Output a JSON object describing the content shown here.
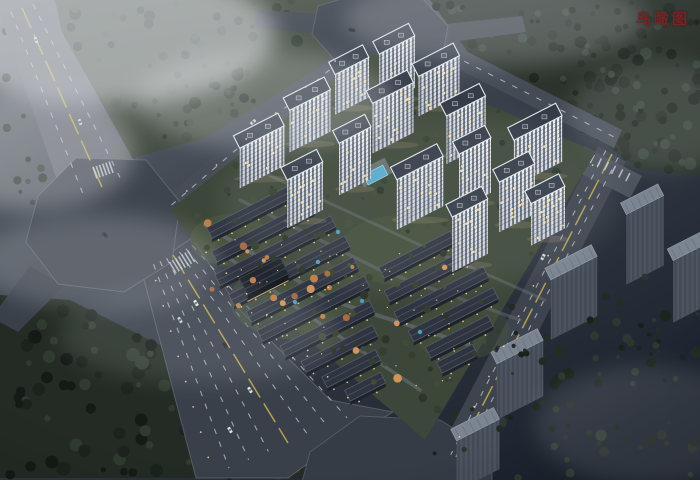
{
  "page": {
    "title_label": "鸟瞰图",
    "title_color": "#7a2125"
  },
  "scene": {
    "w": 700,
    "h": 480,
    "axis_deg": -27,
    "palette": {
      "bg_stops": [
        "#6a6f76",
        "#3a414b",
        "#1b212c"
      ],
      "lane_white": "#b6bec8",
      "lane_yellow": "#c7b14e",
      "tower_roof": "#333b47",
      "tower_trim": "#e3e8ee",
      "facade_top": "#f0f3f6",
      "facade_bot": "#c6ced7",
      "tower_side": "#a9b2bc",
      "window": "#46505c",
      "lit": "#ffdf9e",
      "floor_line": "rgba(52,60,72,0.4)",
      "ctx_roof": "#7b8491",
      "ctx_edge": "#99a1ad",
      "ctx_front": "#4d5561",
      "ctx_stripe": "#424a56",
      "ctx_side": "#363d48",
      "ctx_notch": "#6b7380",
      "villa_roof": "#2e3540",
      "villa_edge": "#525b66",
      "villa_front": "#1d232b",
      "villa_lit": "#f3c67e",
      "club_roof": "#20262e",
      "club_front": "#14181f",
      "club_trim": "#d9b97c",
      "pool": "#57aacb",
      "pool_edge": "#8fd0e4",
      "deck": "#9aa3ac",
      "glow": "#ffd9a2",
      "fog": "#e8ebef"
    },
    "forests": [
      {
        "poly": "0,28 30,16 80,170 40,205 0,205",
        "fill": "none",
        "n": 18,
        "rmin": 2,
        "rmax": 5,
        "colors": [
          "#333d33",
          "#28332a"
        ],
        "seed": 5
      },
      {
        "poly": "55,0 370,0 335,58 205,138 118,162 68,60",
        "fill": "#454e42",
        "n": 70,
        "rmin": 2,
        "rmax": 6,
        "colors": [
          "#333d33",
          "#28332a",
          "#3d483b"
        ],
        "seed": 11
      },
      {
        "poly": "430,0 700,0 700,175 640,170 600,140 470,55",
        "fill": "#2b332c",
        "n": 120,
        "rmin": 2,
        "rmax": 6.5,
        "colors": [
          "#222a23",
          "#1b221c",
          "#36433a"
        ],
        "seed": 22
      },
      {
        "poly": "0,295 70,300 160,345 335,478 0,478",
        "fill": "#232b24",
        "n": 90,
        "rmin": 2.5,
        "rmax": 7,
        "colors": [
          "#1b231c",
          "#2f3b2f",
          "#141a15"
        ],
        "seed": 33
      },
      {
        "poly": "470,320 700,290 700,478 420,478",
        "fill": "none",
        "n": 60,
        "rmin": 2,
        "rmax": 6,
        "colors": [
          "#242c26",
          "#1c241e",
          "#2e3830"
        ],
        "seed": 44
      }
    ],
    "roads": [
      {
        "name": "road-northwest-avenue",
        "poly": "0,16 44,0 138,168 66,206",
        "fill": "#63686f"
      },
      {
        "name": "road-west-exit",
        "poly": "30,266 64,286 18,332 0,322 0,306",
        "fill": "#3a404a"
      },
      {
        "name": "road-boulevard",
        "poly": "192,238 240,310 330,400 393,412 310,462 288,478 196,478 142,272",
        "fill": "#3a404a",
        "stroke": "#7a828c"
      },
      {
        "name": "road-perimeter-nw",
        "poly": "165,198 348,42 362,54 178,212",
        "fill": "#474d57"
      },
      {
        "name": "road-top-exit-left",
        "poly": "258,10 320,14 318,34 254,28",
        "fill": "#41474f"
      },
      {
        "name": "road-top-exit-right",
        "poly": "446,24 522,16 526,32 450,42",
        "fill": "#41474f"
      },
      {
        "name": "road-perimeter-ne",
        "poly": "444,40 622,130 614,148 436,58",
        "fill": "#454b55"
      },
      {
        "name": "road-southeast",
        "poly": "598,146 626,162 470,464 440,450",
        "fill": "#3e444e"
      },
      {
        "name": "parking-east",
        "poly": "584,146 642,176 630,198 574,170",
        "fill": "#4c525c"
      },
      {
        "name": "plaza-west",
        "poly": "38,196 76,158 146,160 180,202 172,262 124,292 58,284 26,242",
        "fill": "#3f454f",
        "stroke": "#777f89"
      },
      {
        "name": "plaza-north",
        "poly": "318,6 352,-4 420,-4 448,26 442,58 398,72 338,64 312,34",
        "fill": "#3d434d",
        "stroke": "#6e7680"
      },
      {
        "name": "plaza-south",
        "poly": "310,452 360,416 440,420 492,452 492,482 302,482",
        "fill": "#363c46",
        "stroke": "#6e7680"
      }
    ],
    "lanes": [
      {
        "e1": [
          0,
          16,
          66,
          206
        ],
        "e2": [
          44,
          0,
          138,
          168
        ],
        "white": [
          0.25,
          0.75
        ],
        "yellow": [
          0.5
        ]
      },
      {
        "e1": [
          200,
          242,
          370,
          408
        ],
        "e2": [
          146,
          268,
          206,
          478
        ],
        "white": [
          0.14,
          0.26,
          0.38,
          0.62,
          0.74,
          0.86
        ],
        "yellow": [
          0.5
        ]
      },
      {
        "e1": [
          598,
          146,
          444,
          452
        ],
        "e2": [
          626,
          162,
          468,
          462
        ],
        "white": [
          0.28,
          0.72
        ],
        "yellow": [
          0.5
        ]
      },
      {
        "e1": [
          165,
          198,
          348,
          42
        ],
        "e2": [
          178,
          212,
          362,
          54
        ],
        "white": [
          0.5
        ],
        "yellow": []
      },
      {
        "e1": [
          444,
          40,
          622,
          130
        ],
        "e2": [
          436,
          58,
          614,
          148
        ],
        "white": [
          0.5
        ],
        "yellow": []
      }
    ],
    "crosswalks": [
      {
        "x": 182,
        "y": 262,
        "dir": 59,
        "n": 7,
        "len": 13,
        "gap": 3.6
      },
      {
        "x": 103,
        "y": 170,
        "dir": 71,
        "n": 6,
        "len": 12,
        "gap": 3.4
      },
      {
        "x": 610,
        "y": 168,
        "dir": 117,
        "n": 6,
        "len": 9,
        "gap": 8
      }
    ],
    "site": {
      "poly": "170,210 368,52 596,152 425,440 393,412 192,240",
      "fill": "#3d4739"
    },
    "lawns": [
      {
        "cx": 300,
        "cy": 300,
        "rx": 70,
        "ry": 40,
        "fill": "#4a573e",
        "op": 0.5
      },
      {
        "cx": 400,
        "cy": 250,
        "rx": 60,
        "ry": 35,
        "fill": "#49563d",
        "op": 0.45
      },
      {
        "cx": 230,
        "cy": 240,
        "rx": 40,
        "ry": 26,
        "fill": "#4d5a40",
        "op": 0.5
      },
      {
        "cx": 460,
        "cy": 330,
        "rx": 50,
        "ry": 30,
        "fill": "#46533c",
        "op": 0.45
      }
    ],
    "paths": [
      {
        "pts": "205,225 330,300 470,345",
        "w": 4,
        "color": "#6d7580",
        "op": 0.55
      },
      {
        "pts": "240,200 380,270 520,320",
        "w": 3.5,
        "color": "#6d7580",
        "op": 0.4
      },
      {
        "pts": "225,255 300,310 420,390",
        "w": 3.5,
        "color": "#707884",
        "op": 0.5
      },
      {
        "pts": "258,170 420,245 545,300",
        "w": 3,
        "color": "#79818c",
        "op": 0.35
      }
    ],
    "villas": [
      [
        252,
        218,
        90
      ],
      [
        266,
        237,
        110
      ],
      [
        278,
        256,
        130
      ],
      [
        292,
        276,
        130
      ],
      [
        305,
        295,
        120
      ],
      [
        316,
        314,
        120
      ],
      [
        330,
        334,
        100
      ],
      [
        342,
        354,
        80
      ],
      [
        354,
        374,
        60
      ],
      [
        368,
        392,
        40
      ],
      [
        420,
        260,
        80
      ],
      [
        432,
        280,
        95
      ],
      [
        444,
        300,
        100
      ],
      [
        456,
        320,
        95
      ],
      [
        462,
        342,
        70
      ],
      [
        460,
        364,
        40
      ]
    ],
    "clubhouse": {
      "cx": 268,
      "cy": 284,
      "w": 46,
      "d": 18,
      "fh": 7
    },
    "pool": {
      "cx": 378,
      "cy": 180,
      "w": 22,
      "d": 11
    },
    "ponds": [
      [
        318,
        262
      ],
      [
        362,
        301
      ],
      [
        295,
        302
      ],
      [
        420,
        332
      ],
      [
        338,
        232
      ]
    ],
    "towers": [
      [
        397,
        45,
        40,
        52
      ],
      [
        352,
        66,
        38,
        40
      ],
      [
        439,
        66,
        46,
        40
      ],
      [
        393,
        93,
        46,
        50
      ],
      [
        310,
        100,
        46,
        42
      ],
      [
        466,
        106,
        44,
        48
      ],
      [
        538,
        128,
        54,
        46
      ],
      [
        355,
        135,
        36,
        52
      ],
      [
        262,
        137,
        50,
        40
      ],
      [
        475,
        146,
        36,
        55
      ],
      [
        420,
        168,
        52,
        50
      ],
      [
        305,
        171,
        40,
        48
      ],
      [
        517,
        173,
        40,
        50
      ],
      [
        548,
        195,
        38,
        42
      ],
      [
        470,
        208,
        40,
        55
      ]
    ],
    "context_buildings": [
      [
        645,
        205,
        42,
        70
      ],
      [
        690,
        252,
        38,
        62
      ],
      [
        574,
        268,
        52,
        60
      ],
      [
        520,
        352,
        52,
        56
      ],
      [
        478,
        430,
        48,
        50
      ]
    ],
    "site_trees": {
      "poly": "170,210 368,52 596,152 425,440 393,412 192,240",
      "n": 120,
      "rmin": 1.5,
      "rmax": 4.5,
      "colors": [
        "#34402f",
        "#2b362a",
        "#3f4d38"
      ],
      "seed": 55
    },
    "accent_trees": {
      "poly": "195,218 480,265 430,400 210,300",
      "n": 22,
      "rmin": 2,
      "rmax": 4.5,
      "colors": [
        "#bd7f49",
        "#cf9559",
        "#a8693c"
      ],
      "seed": 66
    },
    "fg_trees": {
      "poly": "470,300 700,250 700,470 430,470",
      "n": 40,
      "rmin": 1.5,
      "rmax": 4,
      "colors": [
        "#222a24",
        "#1a211b",
        "#2c362c"
      ],
      "seed": 77
    },
    "villa_lights": {
      "poly": "215,232 360,215 500,300 430,410 240,325",
      "n": 40,
      "seed": 88
    },
    "light_rows": [
      [
        196,
        242,
        358,
        408,
        8
      ],
      [
        152,
        268,
        212,
        470,
        8
      ],
      [
        600,
        150,
        452,
        452,
        10
      ],
      [
        172,
        204,
        350,
        48,
        6
      ]
    ],
    "cars": [
      [
        36,
        40,
        71,
        "#dfe3e7"
      ],
      [
        80,
        122,
        71,
        "#c9ced4"
      ],
      [
        196,
        303,
        59,
        "#e8eaec"
      ],
      [
        225,
        345,
        59,
        "#2c323a"
      ],
      [
        250,
        390,
        59,
        "#e4e7ea"
      ],
      [
        180,
        320,
        59,
        "#c9ced4"
      ],
      [
        230,
        430,
        59,
        "#dfe3e7"
      ],
      [
        543,
        257,
        117,
        "#d8dde2"
      ],
      [
        497,
        349,
        117,
        "#2b313a"
      ],
      [
        253,
        122,
        -40,
        "#d0d5da"
      ],
      [
        352,
        30,
        10,
        "#22282f"
      ],
      [
        105,
        235,
        40,
        "#30363e"
      ]
    ],
    "fog": [
      [
        105,
        35,
        170,
        70,
        0.55
      ],
      [
        265,
        100,
        130,
        50,
        0.26
      ],
      [
        35,
        150,
        100,
        60,
        0.32
      ],
      [
        100,
        262,
        120,
        48,
        0.2
      ],
      [
        495,
        20,
        150,
        45,
        0.22
      ],
      [
        660,
        115,
        90,
        55,
        0.15
      ],
      [
        200,
        335,
        140,
        48,
        0.12
      ],
      [
        650,
        425,
        115,
        60,
        0.12
      ],
      [
        420,
        200,
        200,
        90,
        0.07
      ]
    ]
  }
}
